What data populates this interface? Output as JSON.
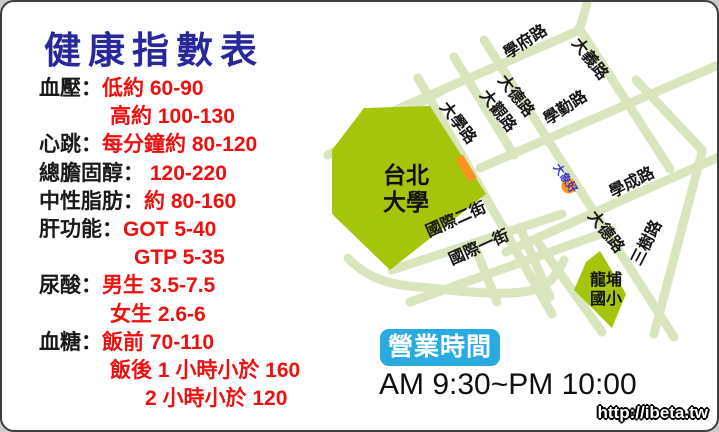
{
  "title": "健康指數表",
  "health": {
    "rows": [
      {
        "label": "血壓：",
        "value": "低約 60-90"
      },
      {
        "label": "",
        "value": "高約 100-130"
      },
      {
        "label": "心跳：",
        "value": "每分鐘約 80-120"
      },
      {
        "label": "總膽固醇：",
        "value": " 120-220"
      },
      {
        "label": "中性脂肪：",
        "value": "約 80-160"
      },
      {
        "label": "肝功能：",
        "value": "GOT 5-40"
      },
      {
        "label": "",
        "value": "GTP 5-35"
      },
      {
        "label": "尿酸：",
        "value": "男生 3.5-7.5"
      },
      {
        "label": "",
        "value": "女生 2.6-6"
      },
      {
        "label": "血糖：",
        "value": "飯前 70-110"
      },
      {
        "label": "",
        "value": "飯後 1 小時小於 160"
      },
      {
        "label": "",
        "value": "2 小時小於 120"
      }
    ]
  },
  "map": {
    "road_labels": [
      "學府路",
      "大義路",
      "大德路",
      "大觀路",
      "大學路",
      "學勤路",
      "學成路",
      "大德路",
      "三樹路",
      "國際二街",
      "國際一街"
    ],
    "places": [
      {
        "name": "台北大學",
        "lines": [
          "台北",
          "大學"
        ]
      },
      {
        "name": "龍埔國小",
        "lines": [
          "龍埔",
          "國小"
        ]
      }
    ],
    "marker_label": "大象好"
  },
  "hours": {
    "badge": "營業時間",
    "time": "AM 9:30~PM 10:00"
  },
  "watermark": "http://ibeta.tw",
  "colors": {
    "title_blue": "#28289a",
    "value_red": "#ee0f0f",
    "road_green": "#d9e6bd",
    "block_green": "#a5c50a",
    "marker_orange": "#f7941e",
    "badge_blue": "#29abe2",
    "marker_text_blue": "#3535c8"
  }
}
